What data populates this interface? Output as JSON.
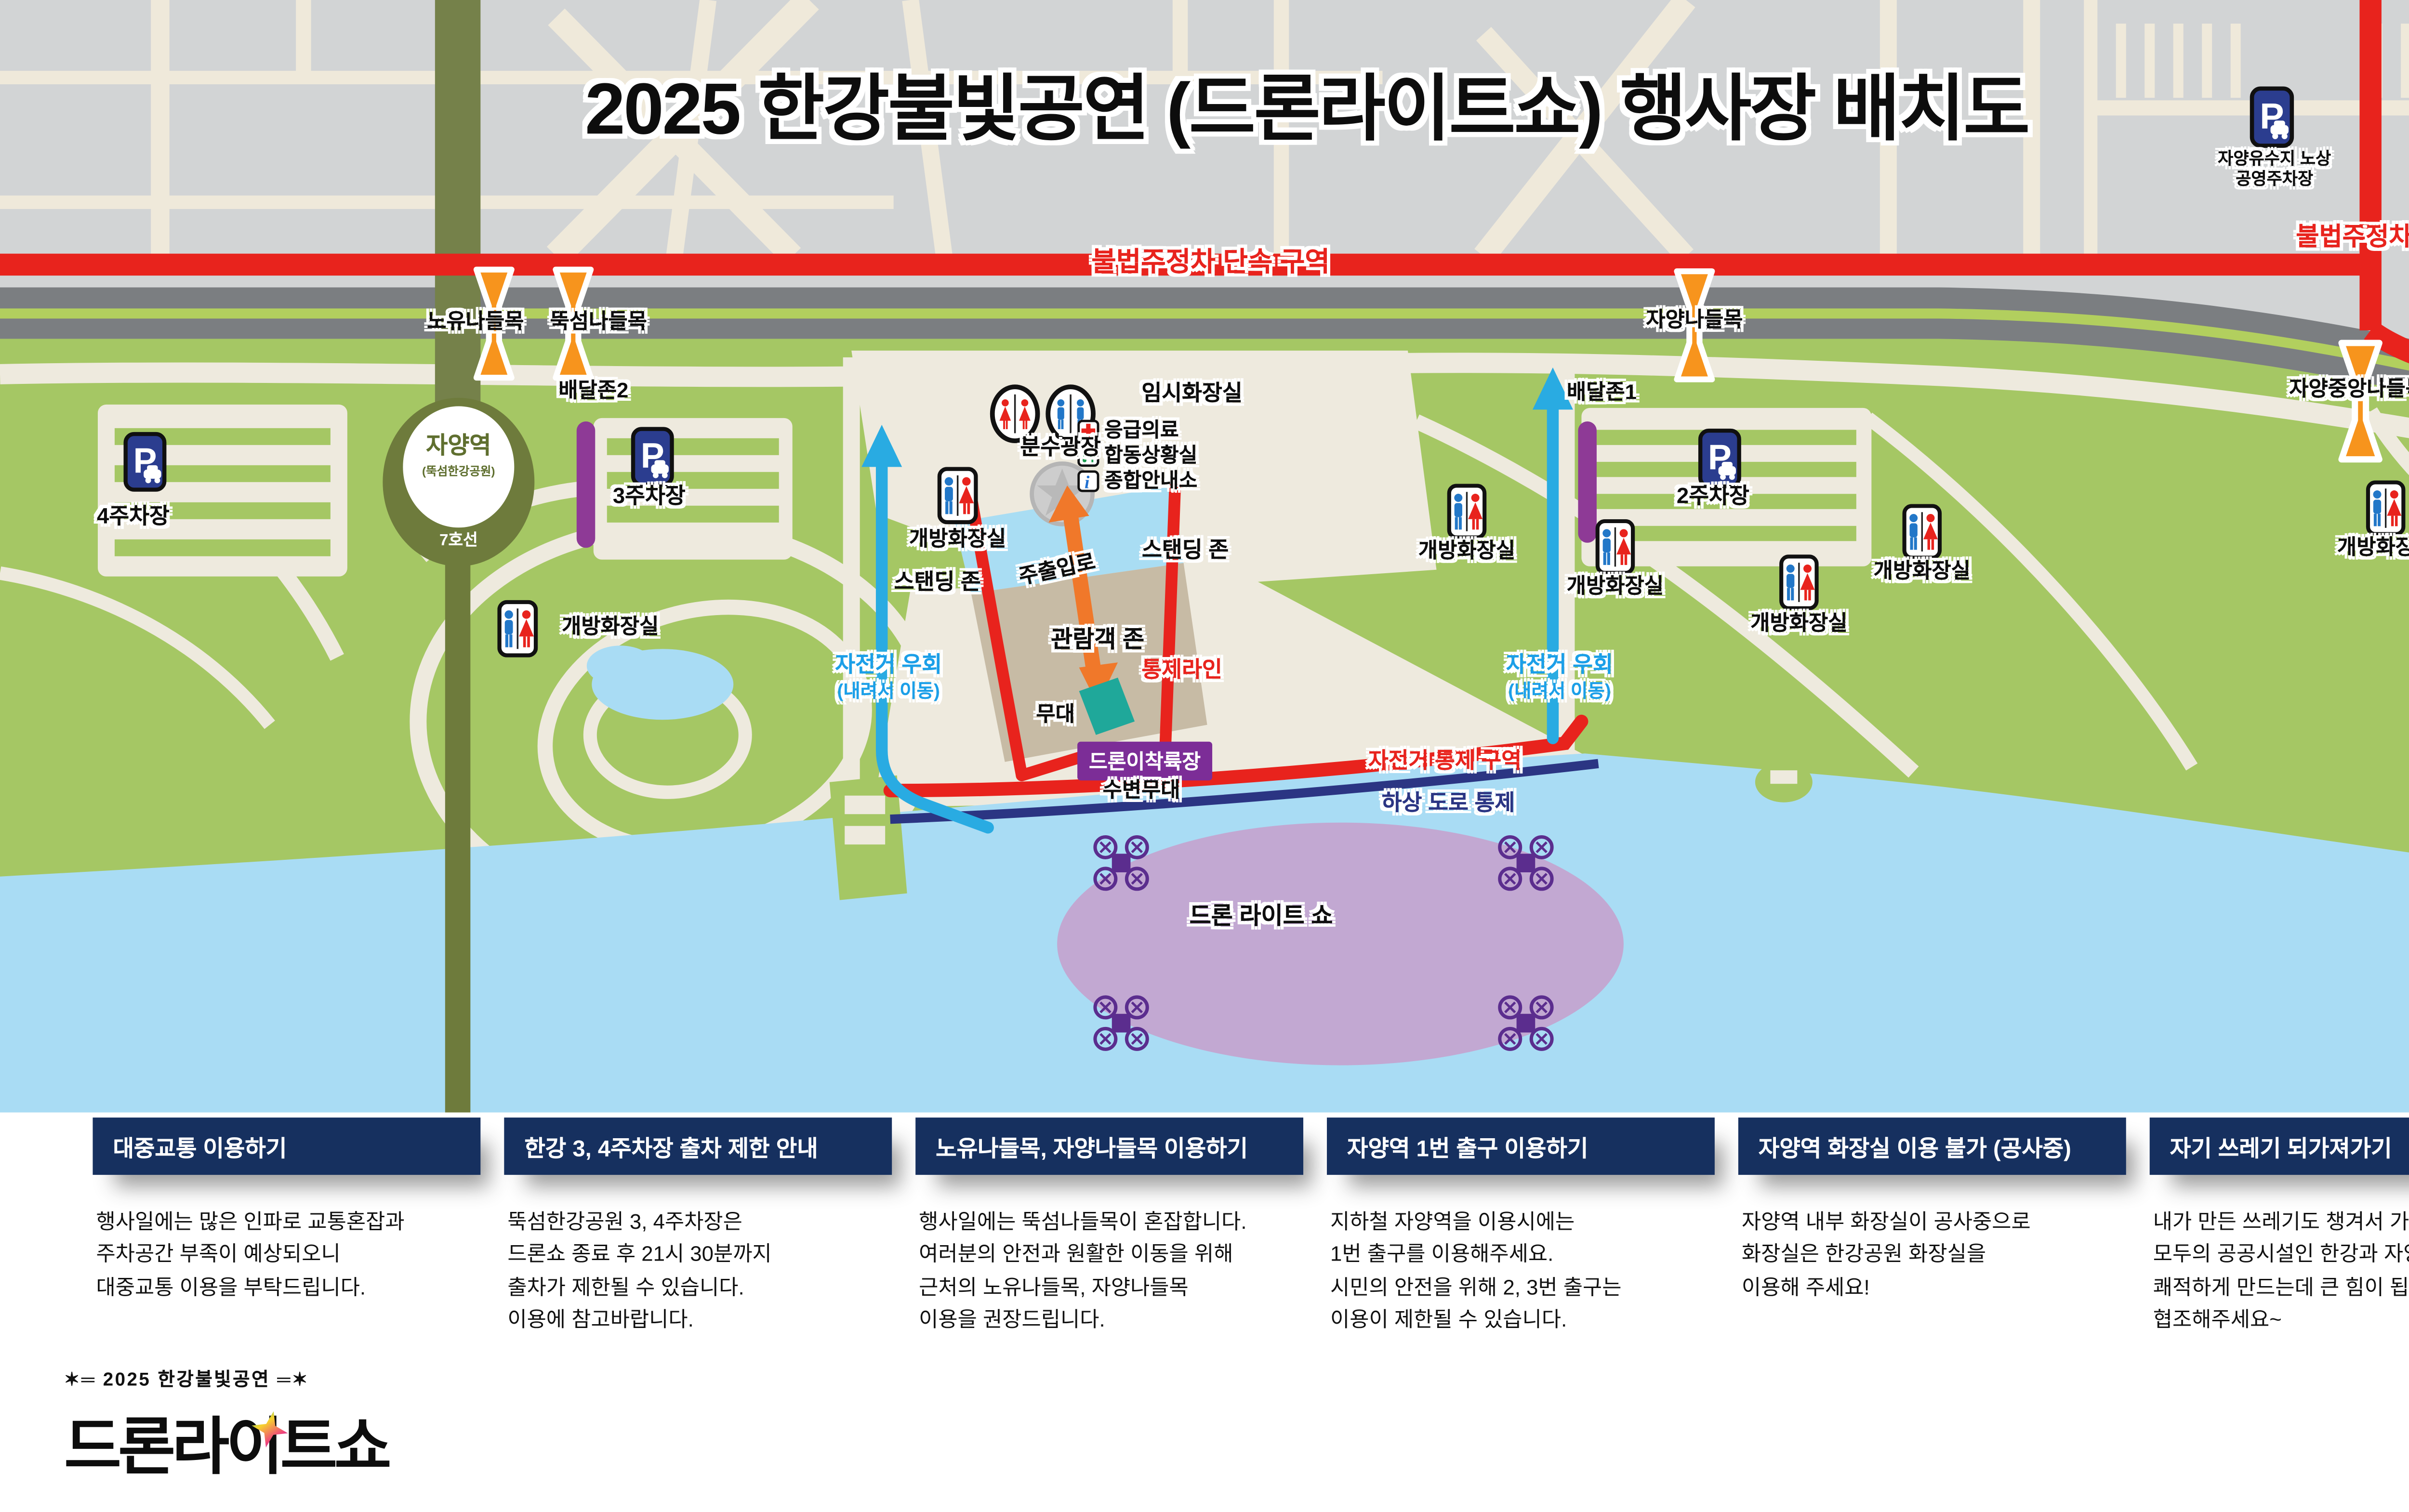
{
  "title": "2025 한강불빛공연 (드론라이트쇼) 행사장 배치도",
  "map": {
    "no_parking_zone": "불법주정차 단속 구역",
    "gates": {
      "noyu": "노유나들목",
      "ttukseom": "뚝섬나들목",
      "jayang": "자양나들목",
      "jayang_central": "자양중앙나들목"
    },
    "station": {
      "name": "자양역",
      "park": "(뚝섬한강공원)",
      "line": "7호선"
    },
    "parking": {
      "p1": "1주차장",
      "p2": "2주차장",
      "p3": "3주차장",
      "p4": "4주차장",
      "reservoir": "자양유수지 노상\n공영주차장"
    },
    "delivery": {
      "zone1": "배달존1",
      "zone2": "배달존2"
    },
    "toilet_open": "개방화장실",
    "toilet_temp": "임시화장실",
    "fountain": "분수광장",
    "medical": "응급의료",
    "situation_room": "합동상황실",
    "info_center": "종합안내소",
    "standing": "스탠딩 존",
    "entrance": "주출입로",
    "audience": "관람객 존",
    "control_line": "통제라인",
    "stage": "무대",
    "drone_pad": "드론이착륙장",
    "waterside_stage": "수변무대",
    "bike_control": "자전거 통제 구역",
    "river_road_closed": "하상 도로 통제",
    "bike_detour_line1": "자전거 우회",
    "bike_detour_line2": "(내려서 이동)",
    "drone_show": "드론 라이트 쇼"
  },
  "info_boxes": [
    {
      "title": "대중교통 이용하기",
      "body": "행사일에는 많은 인파로 교통혼잡과\n주차공간 부족이 예상되오니\n대중교통 이용을 부탁드립니다."
    },
    {
      "title": "한강 3, 4주차장 출차 제한 안내",
      "body": "뚝섬한강공원 3, 4주차장은\n드론쇼 종료 후 21시 30분까지\n출차가 제한될 수 있습니다.\n이용에 참고바랍니다."
    },
    {
      "title": "노유나들목, 자양나들목 이용하기",
      "body": "행사일에는 뚝섬나들목이 혼잡합니다.\n여러분의 안전과 원활한 이동을 위해\n근처의 노유나들목, 자양나들목\n이용을 권장드립니다."
    },
    {
      "title": "자양역 1번 출구 이용하기",
      "body": "지하철 자양역을 이용시에는\n1번 출구를 이용해주세요.\n시민의 안전을 위해 2, 3번 출구는\n이용이 제한될 수 있습니다."
    },
    {
      "title": "자양역 화장실 이용 불가 (공사중)",
      "body": "자양역 내부 화장실이 공사중으로\n화장실은 한강공원 화장실을\n이용해 주세요!"
    },
    {
      "title": "자기 쓰레기 되가져가기",
      "body": "내가 만든 쓰레기도 챙겨서 가져가 주시면\n모두의 공공시설인 한강과 자양역을\n쾌적하게 만드는데 큰 힘이 됩니다.\n협조해주세요~"
    }
  ],
  "footer": {
    "logo_top": "✶═ 2025 한강불빛공연 ═✶",
    "logo_main": "드론라이트쇼",
    "brand": {
      "s": "S",
      "e": "E",
      "heart": "♥",
      "ul": "UL",
      "m": "M",
      "excl": "!",
      "so": "SO",
      "u": "U",
      "l": "L"
    }
  },
  "colors": {
    "park_green": "#a5c764",
    "river_blue": "#a9dcf4",
    "road_gray": "#7b7e81",
    "city_gray": "#d2d4d5",
    "enforcement_red": "#e8231d",
    "header_navy": "#16305f",
    "cone_orange": "#f7941d",
    "delivery_purple": "#8e3a96",
    "drone_zone_lavender": "#c2a8d2",
    "stage_teal": "#1fa89a",
    "bike_blue": "#29abe2"
  }
}
